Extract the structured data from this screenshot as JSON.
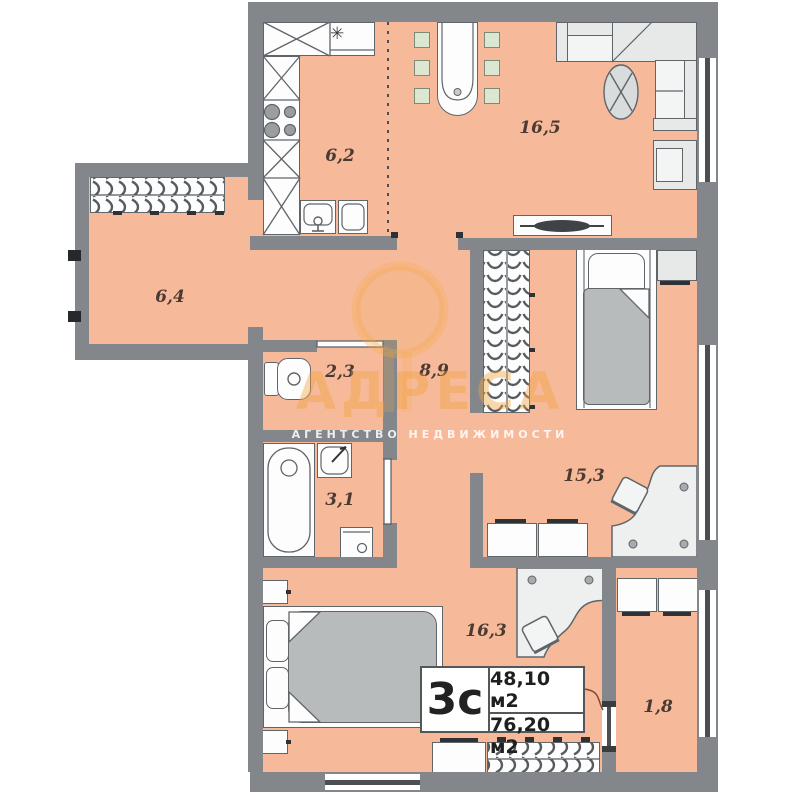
{
  "plan": {
    "unit_label": "3с",
    "area_living": "48,10 м2",
    "area_total": "76,20 м2"
  },
  "rooms": [
    {
      "name": "kitchen",
      "area": "6,2"
    },
    {
      "name": "living-room",
      "area": "16,5"
    },
    {
      "name": "entrance-hall",
      "area": "6,4"
    },
    {
      "name": "toilet",
      "area": "2,3"
    },
    {
      "name": "hallway",
      "area": "8,9"
    },
    {
      "name": "bedroom-1",
      "area": "15,3"
    },
    {
      "name": "bathroom",
      "area": "3,1"
    },
    {
      "name": "bedroom-2",
      "area": "16,3"
    },
    {
      "name": "balcony",
      "area": "1,8"
    }
  ],
  "watermark": {
    "brand": "АДРЕСА",
    "subtitle": "АГЕНТСТВО НЕДВИЖИМОСТИ"
  },
  "icons": {
    "fridge": "✳"
  },
  "colors": {
    "floor": "#f6ba9b",
    "wall": "#83878c",
    "furniture_outline": "#60656a",
    "watermark_accent": "#f0a23c",
    "window_stripe": "#4b4f53"
  }
}
